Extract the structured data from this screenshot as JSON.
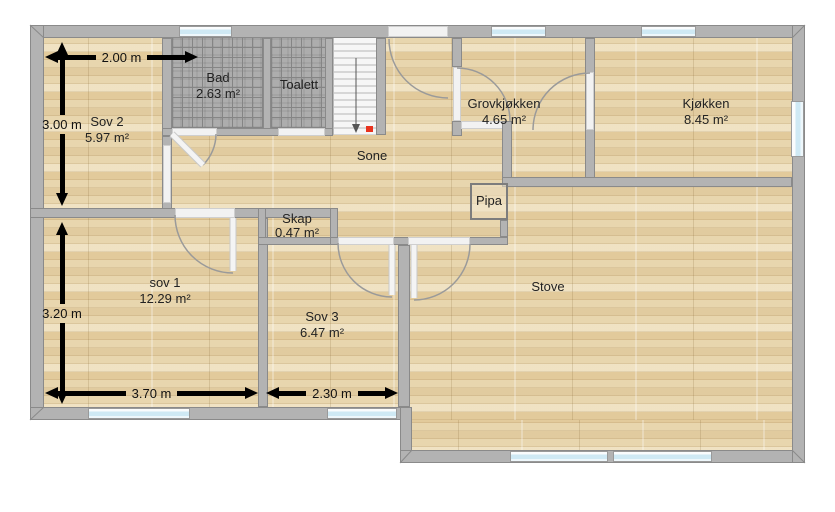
{
  "plan": {
    "rooms": {
      "sov2": {
        "name": "Sov 2",
        "area": "5.97 m²"
      },
      "bad": {
        "name": "Bad",
        "area": "2.63 m²"
      },
      "toalett": {
        "name": "Toalett"
      },
      "sone": {
        "name": "Sone"
      },
      "grovkjokken": {
        "name": "Grovkjøkken",
        "area": "4.65 m²"
      },
      "kjokken": {
        "name": "Kjøkken",
        "area": "8.45 m²"
      },
      "pipa": {
        "name": "Pipa"
      },
      "skap": {
        "name": "Skap",
        "area": "0.47 m²"
      },
      "sov1": {
        "name": "sov 1",
        "area": "12.29 m²"
      },
      "sov3": {
        "name": "Sov 3",
        "area": "6.47 m²"
      },
      "stove": {
        "name": "Stove"
      }
    },
    "dimensions": {
      "sov2_width": "2.00 m",
      "sov2_height": "3.00 m",
      "sov1_height": "3.20 m",
      "sov1_width": "3.70 m",
      "sov3_width": "2.30 m"
    },
    "colors": {
      "wall": "#b3b3b3",
      "floor_wood": "#e8d6ae",
      "floor_tile": "#9a9a9a",
      "window_glass": "#cfe9f4",
      "dimension_arrow": "#000000",
      "stair_marker": "#e8321e"
    }
  }
}
